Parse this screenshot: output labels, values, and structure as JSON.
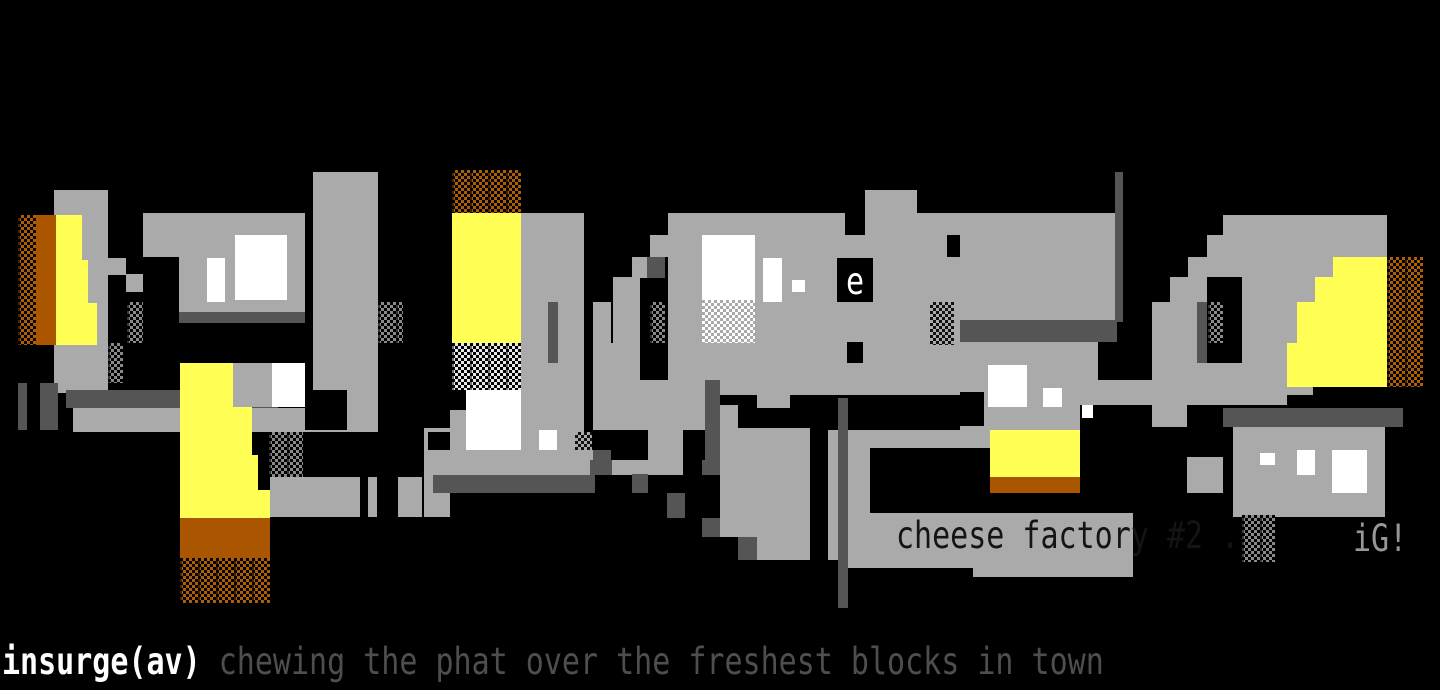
{
  "artwork": {
    "description": "ANSI textmode graffiti artwork: the word insurge painted as large abstract gray blocks with yellow and orange fills on a black background",
    "caption": "cheese factory #2 .",
    "signature": "iG!",
    "e_glyph": "e",
    "footer": {
      "handle": "insurge(av)",
      "tagline": " chewing the phat over the freshest blocks in town"
    },
    "palette": {
      "k": "#000000",
      "g": "#aaaaaa",
      "d": "#555555",
      "w": "#ffffff",
      "y": "#ffff55",
      "o": "#aa5500"
    },
    "pattern_colors": {
      "Ok": "brown shade-dither on black",
      "Gk": "gray shade-dither on black",
      "Kg": "black shade-dither on gray",
      "Wg": "white shade-dither on gray",
      "Wk": "white shade-dither on black"
    },
    "rects": [
      [
        "g",
        54,
        190,
        54,
        203
      ],
      [
        "Ok",
        18,
        215,
        18,
        130
      ],
      [
        "o",
        36,
        215,
        20,
        130
      ],
      [
        "y",
        56,
        215,
        26,
        45
      ],
      [
        "y",
        56,
        260,
        32,
        43
      ],
      [
        "y",
        56,
        303,
        41,
        42
      ],
      [
        "Gk",
        108,
        343,
        15,
        40
      ],
      [
        "Gk",
        127,
        302,
        16,
        41
      ],
      [
        "g",
        108,
        258,
        18,
        17
      ],
      [
        "g",
        126,
        274,
        18,
        18
      ],
      [
        "d",
        18,
        383,
        9,
        47
      ],
      [
        "d",
        40,
        383,
        18,
        47
      ],
      [
        "d",
        66,
        390,
        212,
        18
      ],
      [
        "g",
        73,
        408,
        305,
        24
      ],
      [
        "k",
        305,
        390,
        42,
        40
      ],
      [
        "g",
        347,
        390,
        31,
        42
      ],
      [
        "g",
        143,
        213,
        162,
        99
      ],
      [
        "d",
        179,
        312,
        126,
        11
      ],
      [
        "k",
        143,
        257,
        36,
        66
      ],
      [
        "w",
        235,
        235,
        52,
        65
      ],
      [
        "w",
        207,
        258,
        18,
        44
      ],
      [
        "g",
        313,
        172,
        65,
        218
      ],
      [
        "Gk",
        378,
        302,
        25,
        41
      ],
      [
        "y",
        180,
        363,
        53,
        44
      ],
      [
        "y",
        180,
        407,
        72,
        48
      ],
      [
        "y",
        180,
        455,
        78,
        35
      ],
      [
        "y",
        180,
        490,
        90,
        28
      ],
      [
        "o",
        180,
        518,
        90,
        40
      ],
      [
        "Ok",
        180,
        558,
        90,
        45
      ],
      [
        "g",
        233,
        363,
        39,
        44
      ],
      [
        "w",
        272,
        363,
        33,
        44
      ],
      [
        "Gk",
        269,
        432,
        34,
        45
      ],
      [
        "g",
        270,
        477,
        90,
        40
      ],
      [
        "g",
        368,
        477,
        9,
        40
      ],
      [
        "g",
        398,
        477,
        24,
        40
      ],
      [
        "g",
        424,
        428,
        26,
        89
      ],
      [
        "k",
        428,
        432,
        22,
        18
      ],
      [
        "Ok",
        452,
        170,
        69,
        43
      ],
      [
        "y",
        452,
        213,
        69,
        130
      ],
      [
        "Wk",
        452,
        343,
        69,
        47
      ],
      [
        "g",
        450,
        410,
        16,
        40
      ],
      [
        "w",
        466,
        390,
        55,
        60
      ],
      [
        "g",
        521,
        213,
        63,
        262
      ],
      [
        "d",
        548,
        302,
        10,
        61
      ],
      [
        "g",
        593,
        302,
        18,
        58
      ],
      [
        "g",
        613,
        277,
        27,
        83
      ],
      [
        "g",
        632,
        257,
        18,
        24
      ],
      [
        "g",
        650,
        235,
        18,
        22
      ],
      [
        "d",
        647,
        257,
        18,
        21
      ],
      [
        "k",
        640,
        278,
        28,
        80
      ],
      [
        "Gk",
        650,
        302,
        15,
        41
      ],
      [
        "g",
        593,
        343,
        47,
        37
      ],
      [
        "w",
        539,
        430,
        18,
        20
      ],
      [
        "Kg",
        575,
        432,
        17,
        43
      ],
      [
        "d",
        593,
        450,
        18,
        25
      ],
      [
        "g",
        433,
        450,
        160,
        25
      ],
      [
        "d",
        433,
        475,
        162,
        18
      ],
      [
        "g",
        668,
        213,
        449,
        107
      ],
      [
        "g",
        668,
        320,
        292,
        75
      ],
      [
        "d",
        960,
        320,
        157,
        22
      ],
      [
        "g",
        960,
        342,
        138,
        51
      ],
      [
        "g",
        865,
        190,
        52,
        23
      ],
      [
        "k",
        845,
        213,
        20,
        22
      ],
      [
        "k",
        947,
        235,
        13,
        22
      ],
      [
        "w",
        702,
        235,
        53,
        65
      ],
      [
        "Wg",
        702,
        300,
        53,
        43
      ],
      [
        "w",
        763,
        258,
        19,
        44
      ],
      [
        "w",
        792,
        280,
        13,
        12
      ],
      [
        "k",
        837,
        258,
        36,
        44
      ],
      [
        "k",
        847,
        342,
        16,
        21
      ],
      [
        "Kg",
        930,
        302,
        24,
        43
      ],
      [
        "g",
        960,
        393,
        120,
        37
      ],
      [
        "k",
        960,
        392,
        24,
        34
      ],
      [
        "w",
        988,
        365,
        39,
        42
      ],
      [
        "w",
        1043,
        388,
        19,
        19
      ],
      [
        "w",
        1082,
        398,
        11,
        20
      ],
      [
        "g",
        1080,
        380,
        207,
        25
      ],
      [
        "g",
        593,
        380,
        112,
        50
      ],
      [
        "d",
        705,
        380,
        15,
        95
      ],
      [
        "g",
        720,
        405,
        18,
        132
      ],
      [
        "g",
        757,
        380,
        33,
        28
      ],
      [
        "g",
        648,
        430,
        35,
        45
      ],
      [
        "g",
        612,
        460,
        36,
        15
      ],
      [
        "d",
        590,
        460,
        22,
        15
      ],
      [
        "d",
        702,
        460,
        18,
        15
      ],
      [
        "g",
        738,
        428,
        72,
        132
      ],
      [
        "d",
        632,
        474,
        16,
        19
      ],
      [
        "d",
        667,
        493,
        18,
        25
      ],
      [
        "d",
        702,
        518,
        18,
        19
      ],
      [
        "d",
        738,
        537,
        19,
        23
      ],
      [
        "g",
        828,
        430,
        10,
        130
      ],
      [
        "d",
        838,
        398,
        10,
        210
      ],
      [
        "g",
        848,
        430,
        142,
        18
      ],
      [
        "k",
        870,
        448,
        120,
        65
      ],
      [
        "g",
        848,
        448,
        22,
        112
      ],
      [
        "g",
        848,
        513,
        285,
        55
      ],
      [
        "g",
        973,
        568,
        160,
        9
      ],
      [
        "y",
        990,
        430,
        90,
        47
      ],
      [
        "o",
        990,
        477,
        90,
        16
      ],
      [
        "k",
        1080,
        427,
        107,
        86
      ],
      [
        "g",
        1152,
        405,
        35,
        22
      ],
      [
        "k",
        1187,
        405,
        36,
        52
      ],
      [
        "g",
        1187,
        457,
        36,
        36
      ],
      [
        "d",
        1223,
        408,
        180,
        19
      ],
      [
        "g",
        1233,
        427,
        152,
        90
      ],
      [
        "w",
        1260,
        453,
        15,
        12
      ],
      [
        "w",
        1297,
        450,
        18,
        25
      ],
      [
        "w",
        1332,
        450,
        35,
        43
      ],
      [
        "Gk",
        1242,
        515,
        33,
        47
      ],
      [
        "d",
        1115,
        172,
        8,
        150
      ],
      [
        "g",
        1152,
        342,
        161,
        53
      ],
      [
        "g",
        1152,
        302,
        18,
        40
      ],
      [
        "g",
        1170,
        277,
        18,
        65
      ],
      [
        "g",
        1188,
        257,
        19,
        85
      ],
      [
        "g",
        1207,
        235,
        16,
        107
      ],
      [
        "g",
        1223,
        215,
        164,
        20
      ],
      [
        "g",
        1223,
        235,
        164,
        108
      ],
      [
        "d",
        1197,
        302,
        10,
        61
      ],
      [
        "k",
        1207,
        277,
        35,
        86
      ],
      [
        "Gk",
        1208,
        302,
        15,
        41
      ],
      [
        "y",
        1333,
        257,
        54,
        20
      ],
      [
        "y",
        1315,
        277,
        72,
        25
      ],
      [
        "y",
        1297,
        302,
        90,
        41
      ],
      [
        "y",
        1287,
        343,
        100,
        44
      ],
      [
        "Ok",
        1387,
        257,
        36,
        130
      ]
    ]
  }
}
